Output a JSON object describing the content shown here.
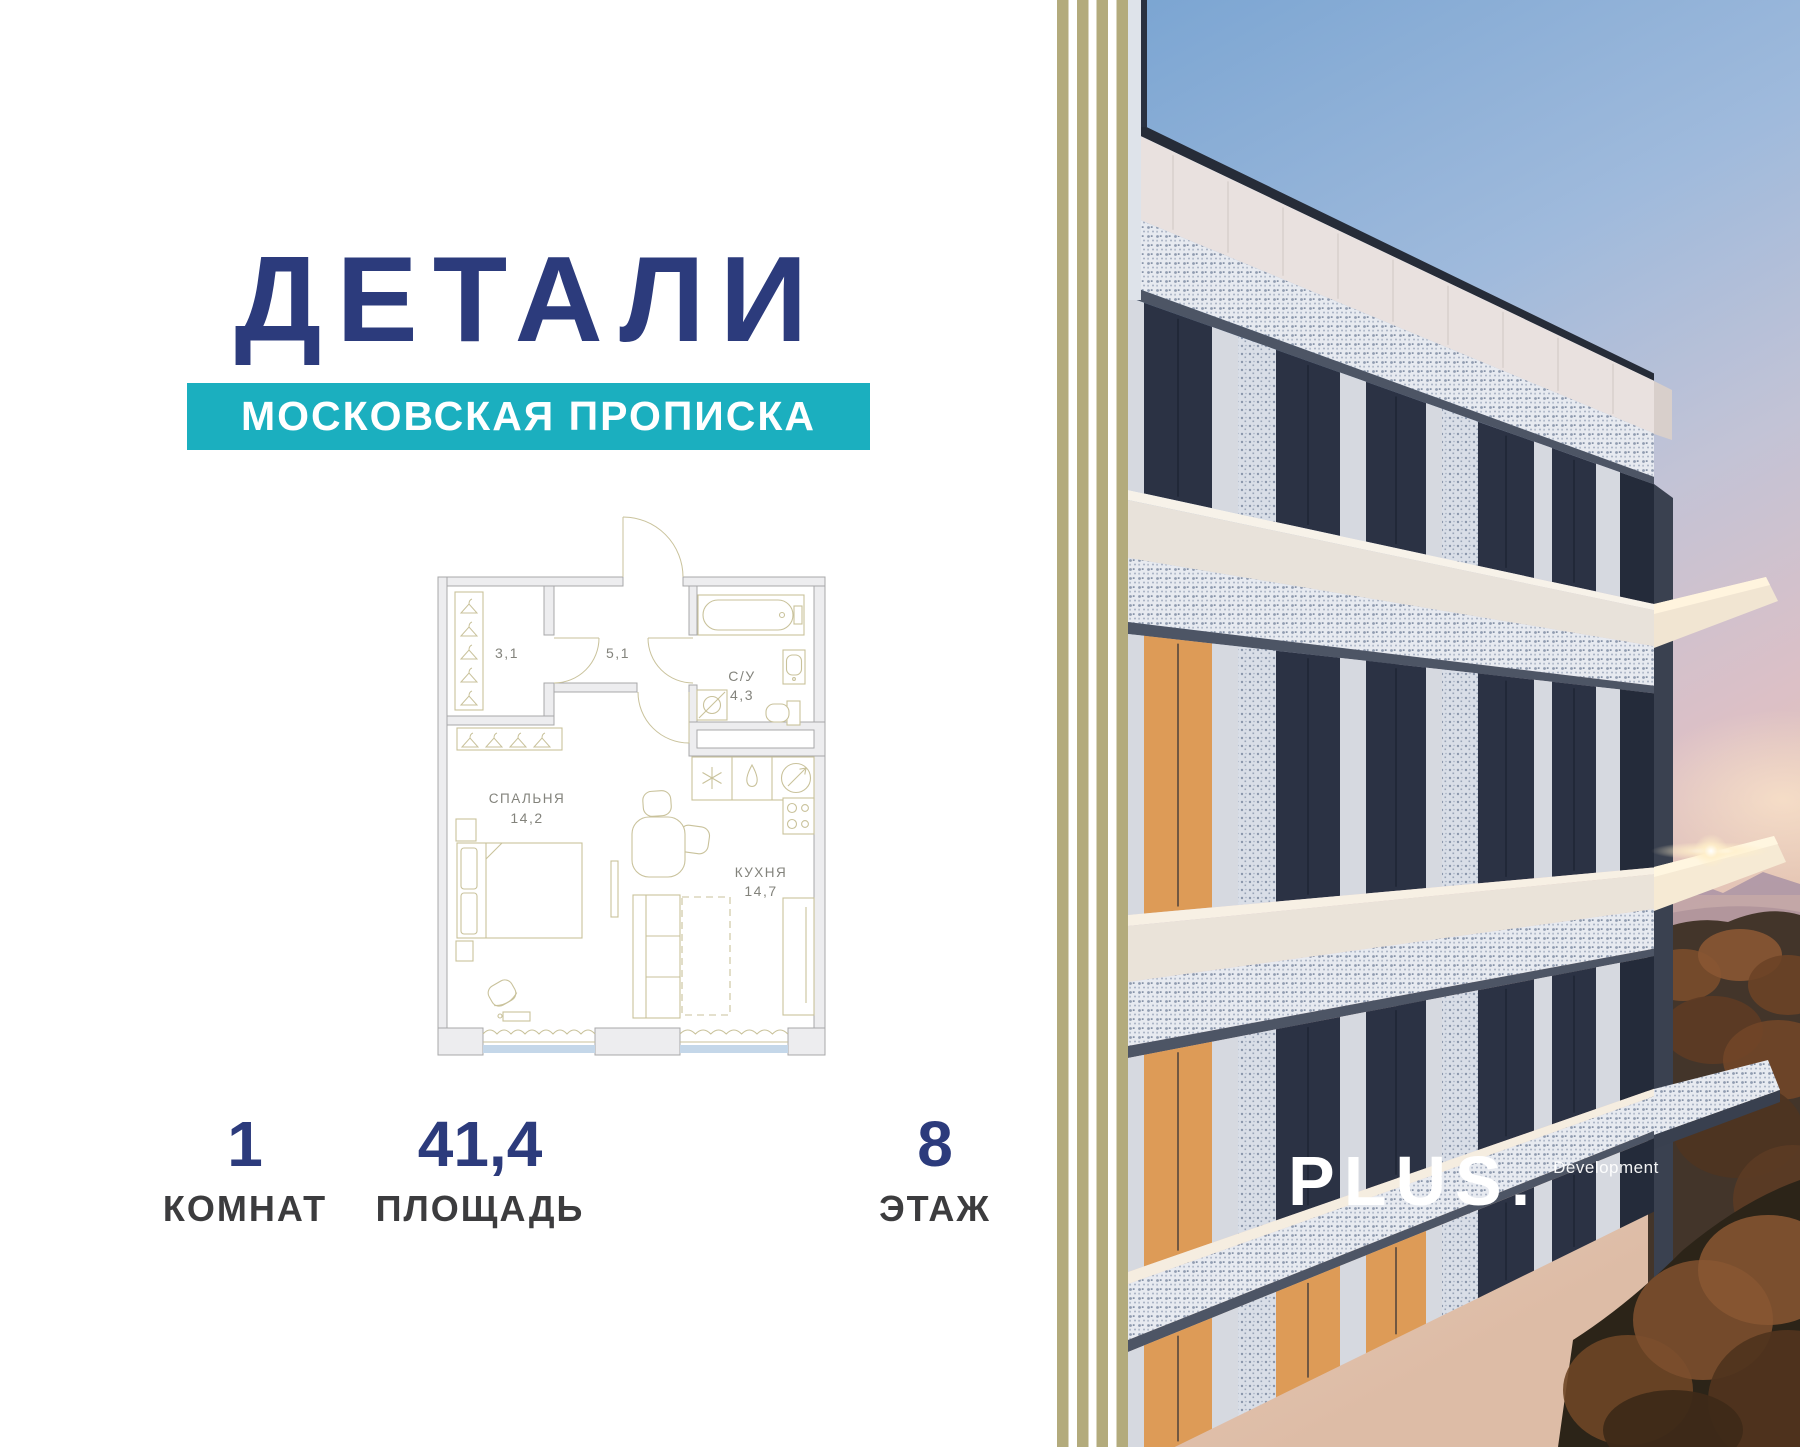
{
  "brand": {
    "logo": "ДЕТАЛИ",
    "banner": "МОСКОВСКАЯ ПРОПИСКА",
    "navy": "#2C3B7C",
    "teal": "#1BAFBF",
    "stripe_khaki": "#B3AB7C"
  },
  "floor_plan": {
    "rooms": [
      {
        "area": "3,1"
      },
      {
        "area": "5,1"
      },
      {
        "label": "С/У",
        "area": "4,3"
      },
      {
        "label": "СПАЛЬНЯ",
        "area": "14,2"
      },
      {
        "label": "КУХНЯ",
        "area": "14,7"
      }
    ]
  },
  "stats": [
    {
      "value": "1",
      "label": "КОМНАТ"
    },
    {
      "value": "41,4",
      "label": "ПЛОЩАДЬ"
    },
    {
      "value": "8",
      "label": "ЭТАЖ"
    }
  ],
  "developer": {
    "name": "PLUS.",
    "suffix": "Development"
  }
}
